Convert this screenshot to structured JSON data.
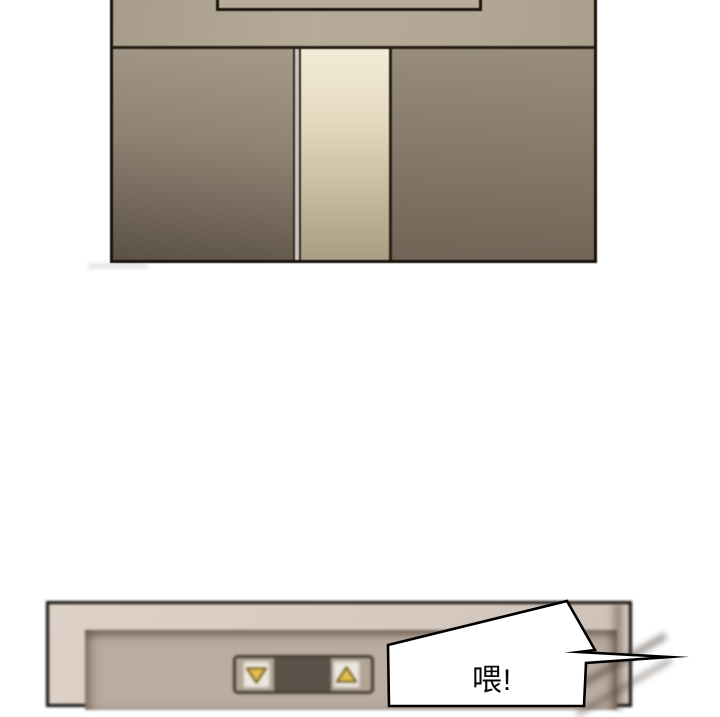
{
  "scene": {
    "type": "comic-elevator-scene",
    "panels": [
      {
        "id": "top",
        "content": "elevator doors with lit gap between them and framed display above"
      },
      {
        "id": "bottom",
        "content": "blurred elevator call-button plate with down and up arrow buttons"
      }
    ]
  },
  "speech_bubble": {
    "text": "喂!"
  },
  "icons": {
    "down_arrow": "down-arrow-icon",
    "up_arrow": "up-arrow-icon"
  },
  "colors": {
    "page_background": "#ffffff",
    "outline": "#17110b",
    "wall_upper": "#b2a695",
    "door_left_top": "#a5998a",
    "door_left_bottom": "#5c5244",
    "door_right_top": "#998e7e",
    "door_right_bottom": "#6f6455",
    "door_light_top": "#f5ecd7",
    "door_light_bottom": "#a89c82",
    "hall_wall": "#d5c9c0",
    "recess": "#b9aca0",
    "plate": "#b2a595",
    "button_face": "#ece7df",
    "arrow_fill": "#e4bc4b",
    "arrow_outline": "#6f5e27",
    "indicator": "#5a5349",
    "bubble_fill": "#ffffff",
    "bubble_outline": "#000000"
  }
}
